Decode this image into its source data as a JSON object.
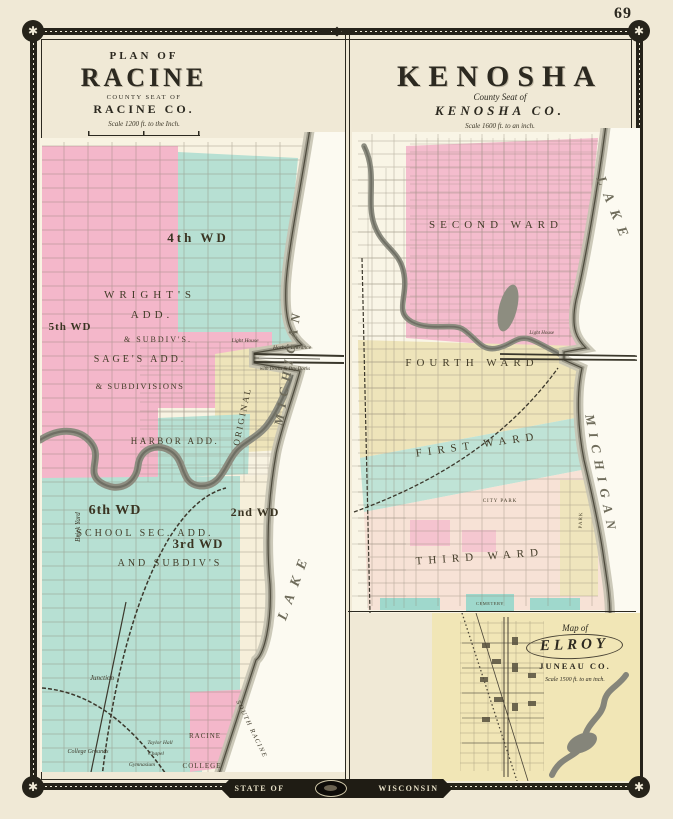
{
  "page": {
    "number": "69",
    "banner": {
      "left": "STATE OF",
      "right": "WISCONSIN"
    }
  },
  "icons": {
    "rosette": "✱",
    "top_ornament": "◆"
  },
  "racine": {
    "header": {
      "line1": "PLAN OF",
      "title": "RACINE",
      "line3": "COUNTY SEAT OF",
      "line4": "RACINE CO.",
      "scale": "Scale 1200 ft. to the Inch."
    },
    "labels": {
      "ward4": "4th WD",
      "wrights": "WRIGHT'S",
      "wrights2": "ADD.",
      "subdiv1": "& SUBDIV'S.",
      "ward5": "5th WD",
      "sages": "SAGE'S ADD.",
      "subdivisions": "& SUBDIVISIONS",
      "harbor_add": "HARBOR ADD.",
      "original": "ORIGINAL",
      "ward6": "6th WD",
      "school_sec": "SCHOOL SEC. ADD.",
      "ward3": "3rd WD",
      "ward2": "2nd WD",
      "and_subdivs": "AND SUBDIV'S",
      "brick_yard": "Brick Yard",
      "junction": "Junction",
      "light_house": "Light House",
      "harbor_entrance": "Harbor Entrance",
      "harbor_note": "with Docks & Dry Docks",
      "south_racine": "SOUTH RACINE",
      "college1": "RACINE",
      "college2": "COLLEGE",
      "taylor_hall": "Taylor Hall",
      "chapel": "Chapel",
      "gymnasium": "Gymnasium",
      "college_grounds": "College Grounds",
      "lake": "LAKE",
      "michigan": "MICHIGAN"
    }
  },
  "kenosha": {
    "header": {
      "title": "KENOSHA",
      "line2": "County Seat of",
      "line3": "KENOSHA CO.",
      "scale": "Scale 1600 ft. to an inch."
    },
    "labels": {
      "second": "SECOND WARD",
      "fourth": "FOURTH WARD",
      "first": "FIRST WARD",
      "third": "THIRD WARD",
      "city_park": "CITY PARK",
      "cemetery": "CEMETERY",
      "park": "PARK",
      "light_house": "Light House",
      "lake": "LAKE",
      "michigan": "MICHIGAN"
    }
  },
  "elroy": {
    "line1": "Map of",
    "title": "ELROY",
    "line3": "JUNEAU CO.",
    "scale": "Scale 1500 ft. to an inch."
  }
}
